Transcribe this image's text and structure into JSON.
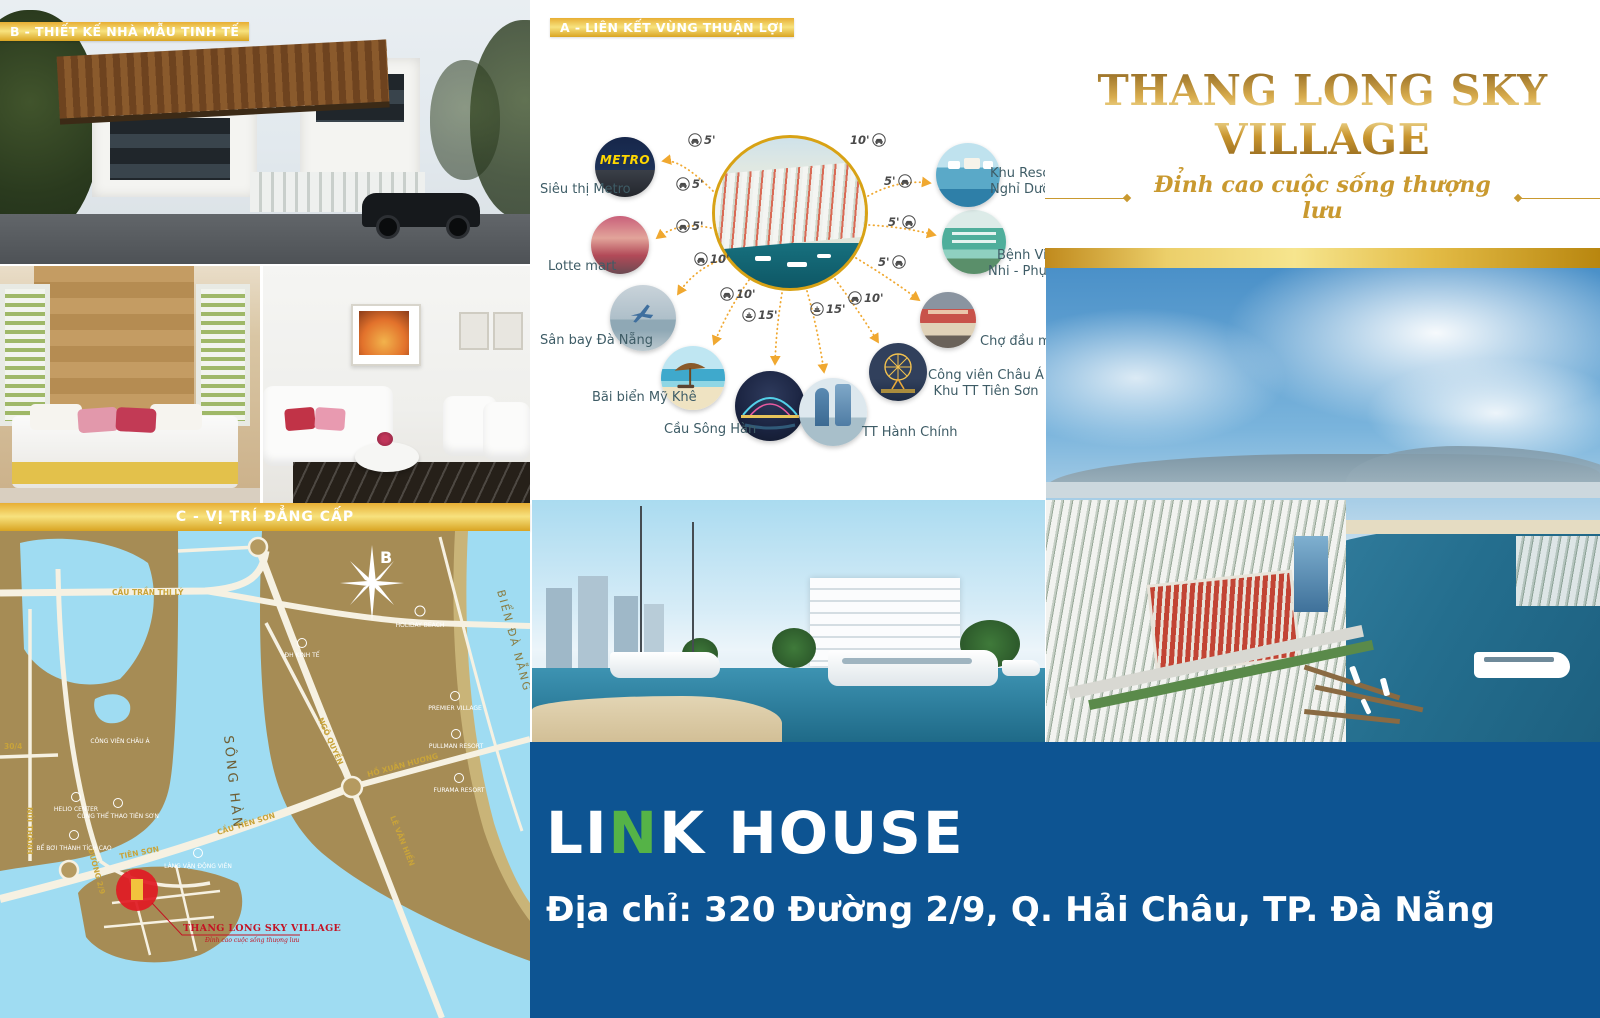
{
  "banners": {
    "a": "A - LIÊN KẾT VÙNG THUẬN LỢI",
    "b": "B - THIẾT KẾ NHÀ MẪU TINH TẾ",
    "c": "C - VỊ TRÍ ĐẲNG CẤP"
  },
  "brand": {
    "title": "THANG LONG SKY VILLAGE",
    "tagline": "Đỉnh cao cuộc sống thượng lưu"
  },
  "diagram": {
    "metro_sign": "METRO",
    "destinations": [
      {
        "label": "Siêu thị Metro"
      },
      {
        "label": "Lotte mart"
      },
      {
        "label": "Sân bay Đà Nẵng"
      },
      {
        "label": "Bãi biển Mỹ Khê"
      },
      {
        "label": "Cầu Sông Hàn"
      },
      {
        "label": "TT Hành Chính"
      },
      {
        "label": "Công viên Châu Á",
        "label2": "Khu TT Tiên Sơn"
      },
      {
        "label": "Chợ đầu mối"
      },
      {
        "label": "Bệnh Viện",
        "label2": "Nhi - Phụ Sản"
      },
      {
        "label": "Khu Resort",
        "label2": "Nghỉ Dưỡng"
      }
    ],
    "times": [
      {
        "value": "5'",
        "mode": "car"
      },
      {
        "value": "5'",
        "mode": "car"
      },
      {
        "value": "5'",
        "mode": "car"
      },
      {
        "value": "10'",
        "mode": "car"
      },
      {
        "value": "10'",
        "mode": "car"
      },
      {
        "value": "15'",
        "mode": "boat"
      },
      {
        "value": "15'",
        "mode": "boat"
      },
      {
        "value": "10'",
        "mode": "car"
      },
      {
        "value": "10'",
        "mode": "car"
      },
      {
        "value": "5'",
        "mode": "car"
      },
      {
        "value": "5'",
        "mode": "car"
      },
      {
        "value": "5'",
        "mode": "car"
      }
    ]
  },
  "map": {
    "compass": "B",
    "sea": "BIỂN ĐÀ NẴNG",
    "river": "SÔNG HÀN",
    "roads": {
      "tran_thi_ly": "CẦU TRẦN THỊ LÝ",
      "ngo_quyen": "NGÔ QUYỀN",
      "ho_xuan_huong": "HỒ XUÂN HƯƠNG",
      "le_van_hien": "LÊ VĂN HIẾN",
      "cau_tien_son": "CẦU TIÊN SƠN",
      "tien_son": "TIÊN SƠN",
      "duong_2_9": "ĐƯỜNG 2/9",
      "nui_thanh": "NÚI THÀNH",
      "road_30_4": "30/4"
    },
    "pois": {
      "holiday_beach": "HOLIDAY BEACH",
      "dh_kinh_te": "ĐH KINH TẾ",
      "premier_village": "PREMIER VILLAGE",
      "pullman_resort": "PULLMAN RESORT",
      "furama_resort": "FURAMA RESORT",
      "cong_vien_chau_a": "CÔNG VIÊN CHÂU Á",
      "helio_center": "HELIO CENTER",
      "cung_the_thao": "CUNG THỂ THAO TIÊN SƠN",
      "be_boi": "BỂ BƠI THÀNH TÍCH CAO",
      "lang_vdv": "LÀNG VẬN ĐỘNG VIÊN"
    },
    "project": {
      "name": "THANG LONG SKY VILLAGE",
      "tagline": "Đỉnh cao cuộc sống thượng lưu"
    }
  },
  "footer": {
    "logo_pre": "LI",
    "logo_n": "N",
    "logo_post": "K HOUSE",
    "address": "Địa chỉ: 320 Đường 2/9, Q. Hải Châu, TP. Đà Nẵng"
  },
  "colors": {
    "gold": "#d8a215",
    "accent_orange": "#f0a830",
    "footer_blue": "#0d5492",
    "logo_green": "#55b347",
    "map_land": "#a68c55",
    "map_water": "#9fdcf2",
    "marker_red": "#e01b24"
  }
}
